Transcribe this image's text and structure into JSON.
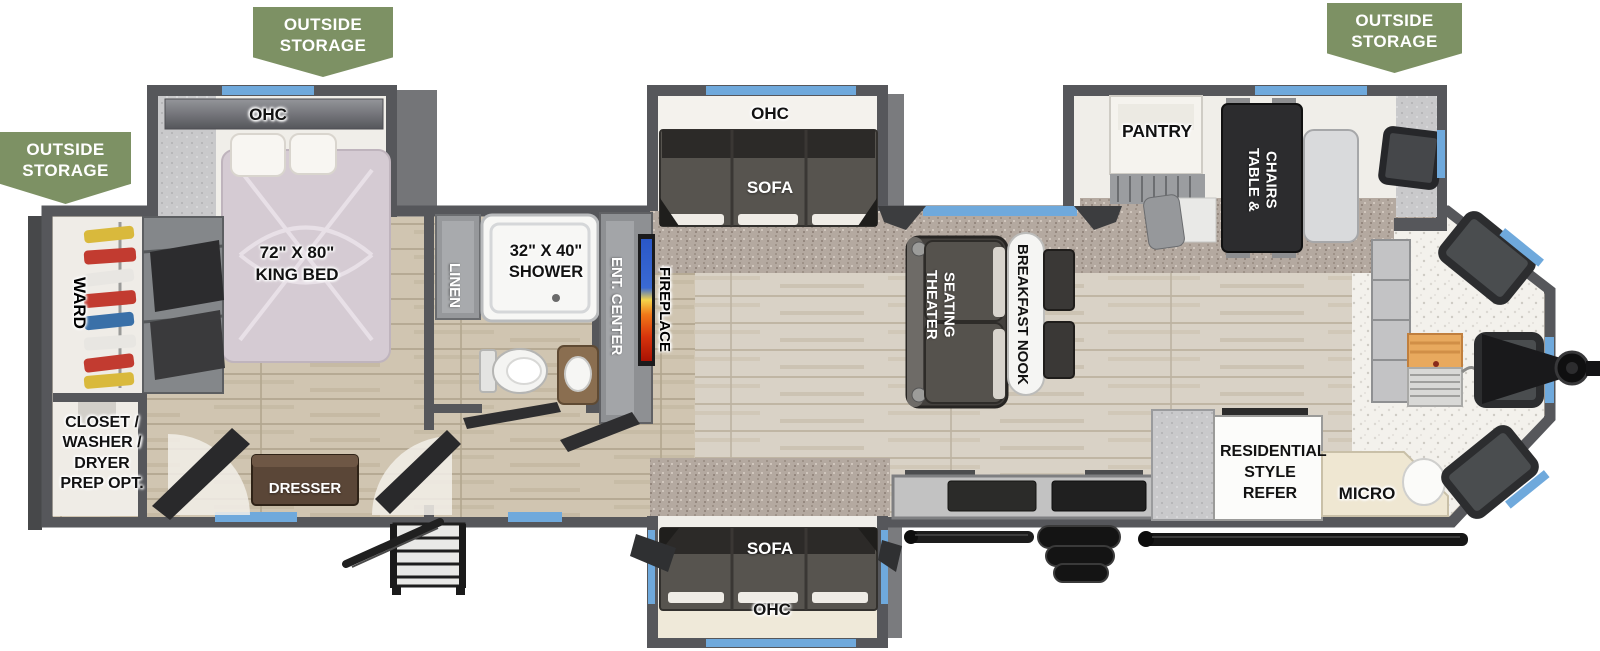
{
  "banners": {
    "top_left": {
      "l1": "OUTSIDE",
      "l2": "STORAGE"
    },
    "left": {
      "l1": "OUTSIDE",
      "l2": "STORAGE"
    },
    "top_right": {
      "l1": "OUTSIDE",
      "l2": "STORAGE"
    }
  },
  "labels": {
    "ohc_bedroom": "OHC",
    "king_bed_size": "72\" X 80\"",
    "king_bed_name": "KING BED",
    "ward": "WARD",
    "closet_l1": "CLOSET /",
    "closet_l2": "WASHER /",
    "closet_l3": "DRYER",
    "closet_l4": "PREP OPT.",
    "dresser": "DRESSER",
    "linen": "LINEN",
    "shower_size": "32\" X 40\"",
    "shower_name": "SHOWER",
    "ent_center": "ENT. CENTER",
    "fireplace": "FIREPLACE",
    "ohc_sofa_top": "OHC",
    "sofa_top": "SOFA",
    "theater_l1": "THEATER",
    "theater_l2": "SEATING",
    "breakfast_nook": "BREAKFAST NOOK",
    "pantry": "PANTRY",
    "table_l1": "TABLE &",
    "table_l2": "CHAIRS",
    "refer_l1": "RESIDENTIAL",
    "refer_l2": "STYLE",
    "refer_l3": "REFER",
    "micro": "MICRO",
    "sofa_bottom": "SOFA",
    "ohc_sofa_bottom": "OHC"
  },
  "colors": {
    "banner_green": "#7D9164",
    "window_blue": "#6FA9DC",
    "wall_gray": "#56575B",
    "carpet": "#B4A9A0",
    "wood_floor": "#D9D2C6",
    "fireplace_blue": "#2A57C8",
    "fireplace_orange": "#F07818",
    "fireplace_red": "#A81204"
  }
}
